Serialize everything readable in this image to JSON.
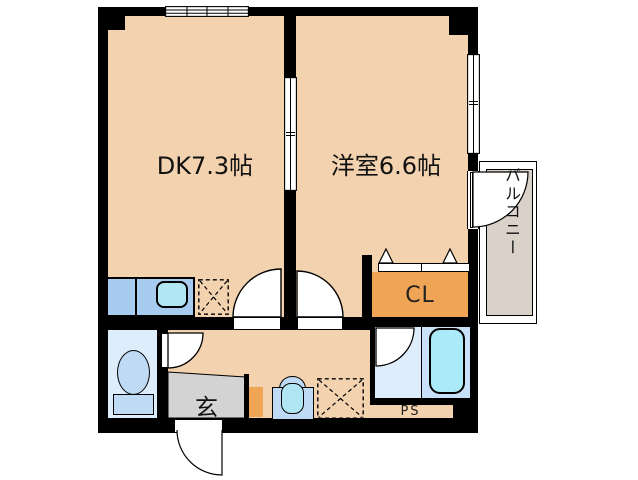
{
  "floorplan": {
    "rooms": {
      "dk": {
        "label": "DK7.3帖"
      },
      "western": {
        "label": "洋室6.6帖"
      },
      "closet": {
        "label": "CL"
      },
      "entrance": {
        "label": "玄"
      },
      "pipe_space": {
        "label": "PS"
      },
      "balcony": {
        "label": "バルコニー"
      }
    },
    "colors": {
      "wall": "#000000",
      "room_floor": "#F3D2AF",
      "entrance_floor": "#D3D3D3",
      "closet_fill": "#F0A455",
      "shoe_cabinet_fill": "#F0A455",
      "kitchen_counter": "#A8CCEF",
      "kitchen_sink": "#B0E6F4",
      "toilet_room_floor": "#DEEDFB",
      "bathroom_floor": "#DEEDFB",
      "bathtub_zone_floor": "#C9E1F8",
      "bathtub": "#ABEBF9",
      "fixture_blue": "#BFDAF5",
      "balcony_floor": "#DAD1C8"
    }
  }
}
